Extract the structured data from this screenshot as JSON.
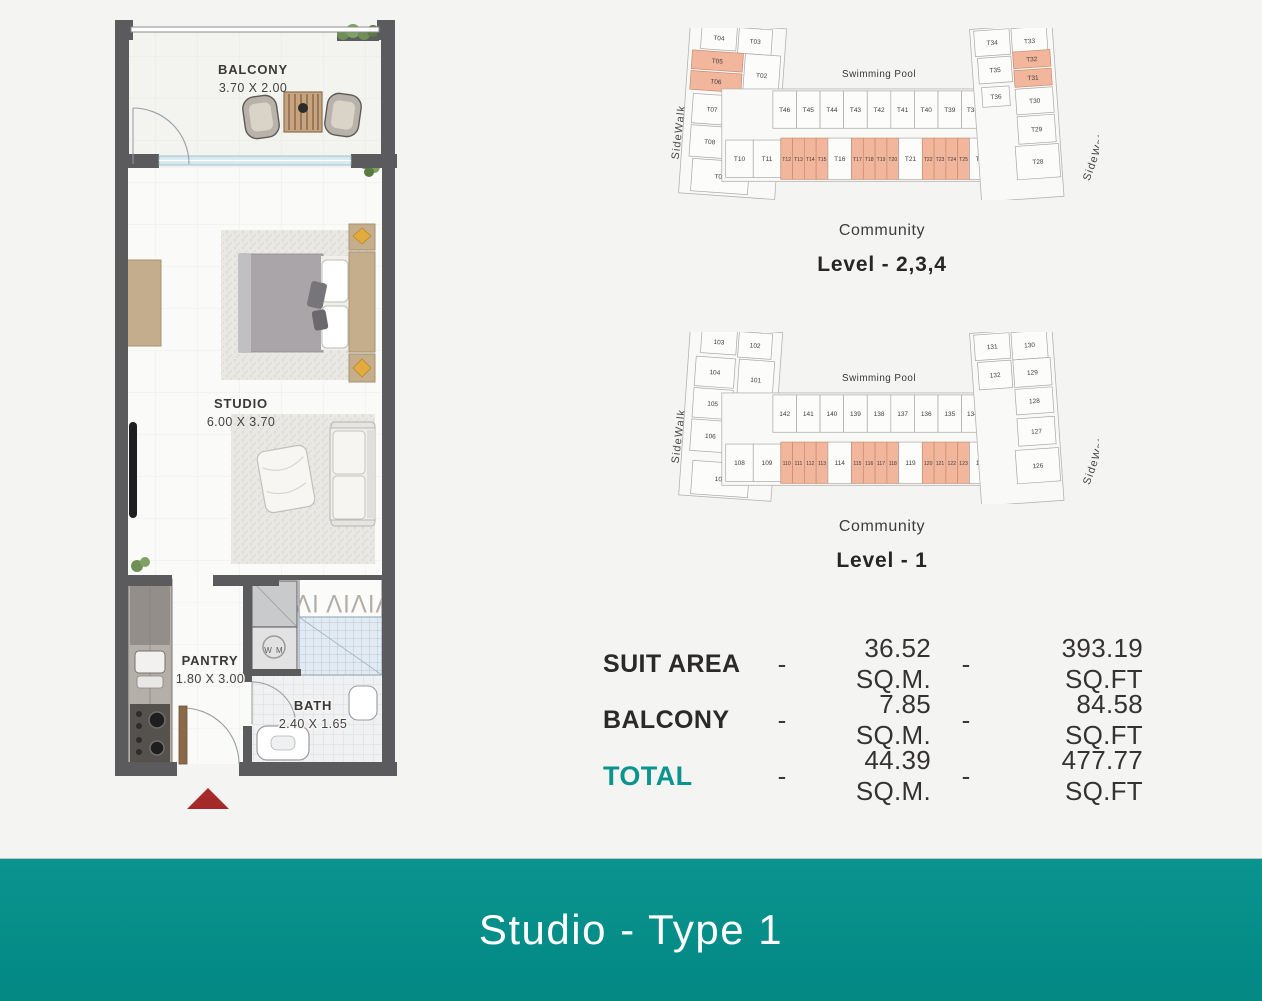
{
  "colors": {
    "accent": "#0a948f",
    "highlight": "#f1b69c",
    "wall": "#5b5b5e",
    "arrow": "#a32a28"
  },
  "floor_plan": {
    "balcony": {
      "name": "BALCONY",
      "dims": "3.70 X 2.00"
    },
    "studio": {
      "name": "STUDIO",
      "dims": "6.00 X 3.70"
    },
    "pantry": {
      "name": "PANTRY",
      "dims": "1.80 X 3.00"
    },
    "bath": {
      "name": "BATH",
      "dims": "2.40 X 1.65"
    },
    "wm_label": "W M",
    "wardrobe_glyphs": "ΙΛΙ ΛΙΛΙΛ"
  },
  "site_plans": [
    {
      "pool_label": "Swimming Pool",
      "sidewalk_left": "SideWalk",
      "sidewalk_right": "SideWalk",
      "community_label": "Community",
      "level_label": "Level - 2,3,4",
      "units": [
        {
          "t": "T04",
          "wing": "left",
          "x": 20,
          "y": 0,
          "w": 36,
          "h": 24,
          "hl": 0
        },
        {
          "t": "T03",
          "wing": "left",
          "x": 58,
          "y": 0,
          "w": 34,
          "h": 26,
          "hl": 0
        },
        {
          "t": "T05",
          "wing": "left",
          "x": 12,
          "y": 26,
          "w": 52,
          "h": 19,
          "hl": 1
        },
        {
          "t": "T02",
          "wing": "left",
          "x": 66,
          "y": 26,
          "w": 36,
          "h": 42,
          "hl": 0
        },
        {
          "t": "T06",
          "wing": "left",
          "x": 12,
          "y": 47,
          "w": 52,
          "h": 19,
          "hl": 1
        },
        {
          "t": "T07",
          "wing": "left",
          "x": 16,
          "y": 70,
          "w": 40,
          "h": 30,
          "hl": 0
        },
        {
          "t": "T01",
          "wing": "left",
          "x": 60,
          "y": 74,
          "w": 26,
          "h": 20,
          "hl": 0
        },
        {
          "t": "T08",
          "wing": "left",
          "x": 16,
          "y": 102,
          "w": 40,
          "h": 32,
          "hl": 0
        },
        {
          "t": "T09",
          "wing": "left",
          "x": 20,
          "y": 136,
          "w": 58,
          "h": 33,
          "hl": 0
        },
        {
          "t": "T46",
          "wing": "mid",
          "x": 104,
          "y": 64,
          "w": 24,
          "h": 38,
          "hl": 0
        },
        {
          "t": "T45",
          "wing": "mid",
          "x": 128,
          "y": 64,
          "w": 24,
          "h": 38,
          "hl": 0
        },
        {
          "t": "T44",
          "wing": "mid",
          "x": 152,
          "y": 64,
          "w": 24,
          "h": 38,
          "hl": 0
        },
        {
          "t": "T43",
          "wing": "mid",
          "x": 176,
          "y": 64,
          "w": 24,
          "h": 38,
          "hl": 0
        },
        {
          "t": "T42",
          "wing": "mid",
          "x": 200,
          "y": 64,
          "w": 24,
          "h": 38,
          "hl": 0
        },
        {
          "t": "T41",
          "wing": "mid",
          "x": 224,
          "y": 64,
          "w": 24,
          "h": 38,
          "hl": 0
        },
        {
          "t": "T40",
          "wing": "mid",
          "x": 248,
          "y": 64,
          "w": 24,
          "h": 38,
          "hl": 0
        },
        {
          "t": "T39",
          "wing": "mid",
          "x": 272,
          "y": 64,
          "w": 24,
          "h": 38,
          "hl": 0
        },
        {
          "t": "T38",
          "wing": "mid",
          "x": 296,
          "y": 64,
          "w": 22,
          "h": 38,
          "hl": 0
        },
        {
          "t": "T37",
          "wing": "mid",
          "x": 318,
          "y": 66,
          "w": 16,
          "h": 30,
          "hl": 0
        },
        {
          "t": "T10",
          "wing": "mid",
          "x": 56,
          "y": 114,
          "w": 28,
          "h": 38,
          "hl": 0
        },
        {
          "t": "T11",
          "wing": "mid",
          "x": 84,
          "y": 114,
          "w": 28,
          "h": 38,
          "hl": 0
        },
        {
          "t": "T12",
          "wing": "mid",
          "x": 112,
          "y": 112,
          "w": 12,
          "h": 42,
          "hl": 1
        },
        {
          "t": "T13",
          "wing": "mid",
          "x": 124,
          "y": 112,
          "w": 12,
          "h": 42,
          "hl": 1
        },
        {
          "t": "T14",
          "wing": "mid",
          "x": 136,
          "y": 112,
          "w": 12,
          "h": 42,
          "hl": 1
        },
        {
          "t": "T15",
          "wing": "mid",
          "x": 148,
          "y": 112,
          "w": 12,
          "h": 42,
          "hl": 1
        },
        {
          "t": "T16",
          "wing": "mid",
          "x": 160,
          "y": 112,
          "w": 24,
          "h": 42,
          "hl": 0
        },
        {
          "t": "T17",
          "wing": "mid",
          "x": 184,
          "y": 112,
          "w": 12,
          "h": 42,
          "hl": 1
        },
        {
          "t": "T18",
          "wing": "mid",
          "x": 196,
          "y": 112,
          "w": 12,
          "h": 42,
          "hl": 1
        },
        {
          "t": "T19",
          "wing": "mid",
          "x": 208,
          "y": 112,
          "w": 12,
          "h": 42,
          "hl": 1
        },
        {
          "t": "T20",
          "wing": "mid",
          "x": 220,
          "y": 112,
          "w": 12,
          "h": 42,
          "hl": 1
        },
        {
          "t": "T21",
          "wing": "mid",
          "x": 232,
          "y": 112,
          "w": 24,
          "h": 42,
          "hl": 0
        },
        {
          "t": "T22",
          "wing": "mid",
          "x": 256,
          "y": 112,
          "w": 12,
          "h": 42,
          "hl": 1
        },
        {
          "t": "T23",
          "wing": "mid",
          "x": 268,
          "y": 112,
          "w": 12,
          "h": 42,
          "hl": 1
        },
        {
          "t": "T24",
          "wing": "mid",
          "x": 280,
          "y": 112,
          "w": 12,
          "h": 42,
          "hl": 1
        },
        {
          "t": "T25",
          "wing": "mid",
          "x": 292,
          "y": 112,
          "w": 12,
          "h": 42,
          "hl": 1
        },
        {
          "t": "T26",
          "wing": "mid",
          "x": 304,
          "y": 112,
          "w": 24,
          "h": 42,
          "hl": 0
        },
        {
          "t": "T27",
          "wing": "mid",
          "x": 330,
          "y": 112,
          "w": 14,
          "h": 42,
          "hl": 1
        },
        {
          "t": "T34",
          "wing": "right",
          "x": 320,
          "y": 0,
          "w": 36,
          "h": 26,
          "hl": 0
        },
        {
          "t": "T33",
          "wing": "right",
          "x": 358,
          "y": 0,
          "w": 36,
          "h": 28,
          "hl": 0
        },
        {
          "t": "T35",
          "wing": "right",
          "x": 322,
          "y": 28,
          "w": 34,
          "h": 26,
          "hl": 0
        },
        {
          "t": "T32",
          "wing": "right",
          "x": 358,
          "y": 24,
          "w": 38,
          "h": 17,
          "hl": 1
        },
        {
          "t": "T31",
          "wing": "right",
          "x": 358,
          "y": 43,
          "w": 38,
          "h": 17,
          "hl": 1
        },
        {
          "t": "T36",
          "wing": "right",
          "x": 324,
          "y": 58,
          "w": 28,
          "h": 20,
          "hl": 0
        },
        {
          "t": "T30",
          "wing": "right",
          "x": 358,
          "y": 62,
          "w": 38,
          "h": 26,
          "hl": 0
        },
        {
          "t": "T29",
          "wing": "right",
          "x": 358,
          "y": 90,
          "w": 38,
          "h": 28,
          "hl": 0
        },
        {
          "t": "T28",
          "wing": "right",
          "x": 354,
          "y": 120,
          "w": 44,
          "h": 34,
          "hl": 0
        }
      ]
    },
    {
      "pool_label": "Swimming Pool",
      "sidewalk_left": "SideWalk",
      "sidewalk_right": "SideWalk",
      "community_label": "Community",
      "level_label": "Level - 1",
      "units": [
        {
          "t": "103",
          "wing": "left",
          "x": 20,
          "y": 0,
          "w": 36,
          "h": 24,
          "hl": 0
        },
        {
          "t": "102",
          "wing": "left",
          "x": 58,
          "y": 0,
          "w": 34,
          "h": 26,
          "hl": 0
        },
        {
          "t": "104",
          "wing": "left",
          "x": 16,
          "y": 28,
          "w": 40,
          "h": 30,
          "hl": 0
        },
        {
          "t": "101",
          "wing": "left",
          "x": 60,
          "y": 28,
          "w": 36,
          "h": 40,
          "hl": 0
        },
        {
          "t": "105",
          "wing": "left",
          "x": 16,
          "y": 60,
          "w": 40,
          "h": 30,
          "hl": 0
        },
        {
          "t": "106",
          "wing": "left",
          "x": 16,
          "y": 92,
          "w": 40,
          "h": 32,
          "hl": 0
        },
        {
          "t": "107",
          "wing": "left",
          "x": 20,
          "y": 134,
          "w": 58,
          "h": 34,
          "hl": 0
        },
        {
          "t": "142",
          "wing": "mid",
          "x": 104,
          "y": 64,
          "w": 24,
          "h": 38,
          "hl": 0
        },
        {
          "t": "141",
          "wing": "mid",
          "x": 128,
          "y": 64,
          "w": 24,
          "h": 38,
          "hl": 0
        },
        {
          "t": "140",
          "wing": "mid",
          "x": 152,
          "y": 64,
          "w": 24,
          "h": 38,
          "hl": 0
        },
        {
          "t": "139",
          "wing": "mid",
          "x": 176,
          "y": 64,
          "w": 24,
          "h": 38,
          "hl": 0
        },
        {
          "t": "138",
          "wing": "mid",
          "x": 200,
          "y": 64,
          "w": 24,
          "h": 38,
          "hl": 0
        },
        {
          "t": "137",
          "wing": "mid",
          "x": 224,
          "y": 64,
          "w": 24,
          "h": 38,
          "hl": 0
        },
        {
          "t": "136",
          "wing": "mid",
          "x": 248,
          "y": 64,
          "w": 24,
          "h": 38,
          "hl": 0
        },
        {
          "t": "135",
          "wing": "mid",
          "x": 272,
          "y": 64,
          "w": 24,
          "h": 38,
          "hl": 0
        },
        {
          "t": "134",
          "wing": "mid",
          "x": 296,
          "y": 64,
          "w": 22,
          "h": 38,
          "hl": 0
        },
        {
          "t": "133",
          "wing": "mid",
          "x": 318,
          "y": 66,
          "w": 16,
          "h": 30,
          "hl": 0
        },
        {
          "t": "108",
          "wing": "mid",
          "x": 56,
          "y": 114,
          "w": 28,
          "h": 38,
          "hl": 0
        },
        {
          "t": "109",
          "wing": "mid",
          "x": 84,
          "y": 114,
          "w": 28,
          "h": 38,
          "hl": 0
        },
        {
          "t": "110",
          "wing": "mid",
          "x": 112,
          "y": 112,
          "w": 12,
          "h": 42,
          "hl": 1
        },
        {
          "t": "111",
          "wing": "mid",
          "x": 124,
          "y": 112,
          "w": 12,
          "h": 42,
          "hl": 1
        },
        {
          "t": "112",
          "wing": "mid",
          "x": 136,
          "y": 112,
          "w": 12,
          "h": 42,
          "hl": 1
        },
        {
          "t": "113",
          "wing": "mid",
          "x": 148,
          "y": 112,
          "w": 12,
          "h": 42,
          "hl": 1
        },
        {
          "t": "114",
          "wing": "mid",
          "x": 160,
          "y": 112,
          "w": 24,
          "h": 42,
          "hl": 0
        },
        {
          "t": "115",
          "wing": "mid",
          "x": 184,
          "y": 112,
          "w": 12,
          "h": 42,
          "hl": 1
        },
        {
          "t": "116",
          "wing": "mid",
          "x": 196,
          "y": 112,
          "w": 12,
          "h": 42,
          "hl": 1
        },
        {
          "t": "117",
          "wing": "mid",
          "x": 208,
          "y": 112,
          "w": 12,
          "h": 42,
          "hl": 1
        },
        {
          "t": "118",
          "wing": "mid",
          "x": 220,
          "y": 112,
          "w": 12,
          "h": 42,
          "hl": 1
        },
        {
          "t": "119",
          "wing": "mid",
          "x": 232,
          "y": 112,
          "w": 24,
          "h": 42,
          "hl": 0
        },
        {
          "t": "120",
          "wing": "mid",
          "x": 256,
          "y": 112,
          "w": 12,
          "h": 42,
          "hl": 1
        },
        {
          "t": "121",
          "wing": "mid",
          "x": 268,
          "y": 112,
          "w": 12,
          "h": 42,
          "hl": 1
        },
        {
          "t": "122",
          "wing": "mid",
          "x": 280,
          "y": 112,
          "w": 12,
          "h": 42,
          "hl": 1
        },
        {
          "t": "123",
          "wing": "mid",
          "x": 292,
          "y": 112,
          "w": 12,
          "h": 42,
          "hl": 1
        },
        {
          "t": "124",
          "wing": "mid",
          "x": 304,
          "y": 112,
          "w": 24,
          "h": 42,
          "hl": 0
        },
        {
          "t": "125",
          "wing": "mid",
          "x": 330,
          "y": 112,
          "w": 14,
          "h": 42,
          "hl": 1
        },
        {
          "t": "131",
          "wing": "right",
          "x": 320,
          "y": 0,
          "w": 36,
          "h": 26,
          "hl": 0
        },
        {
          "t": "130",
          "wing": "right",
          "x": 358,
          "y": 0,
          "w": 36,
          "h": 28,
          "hl": 0
        },
        {
          "t": "132",
          "wing": "right",
          "x": 322,
          "y": 28,
          "w": 34,
          "h": 28,
          "hl": 0
        },
        {
          "t": "129",
          "wing": "right",
          "x": 358,
          "y": 28,
          "w": 38,
          "h": 28,
          "hl": 0
        },
        {
          "t": "128",
          "wing": "right",
          "x": 358,
          "y": 58,
          "w": 38,
          "h": 26,
          "hl": 0
        },
        {
          "t": "127",
          "wing": "right",
          "x": 358,
          "y": 88,
          "w": 38,
          "h": 28,
          "hl": 0
        },
        {
          "t": "126",
          "wing": "right",
          "x": 354,
          "y": 120,
          "w": 44,
          "h": 34,
          "hl": 0
        }
      ]
    }
  ],
  "areas": {
    "rows": [
      {
        "label": "SUIT AREA",
        "sep1": "-",
        "sqm": "36.52 SQ.M.",
        "sep2": "-",
        "sqft": "393.19 SQ.FT",
        "accent": false
      },
      {
        "label": "BALCONY",
        "sep1": "-",
        "sqm": "7.85 SQ.M.",
        "sep2": "-",
        "sqft": "84.58 SQ.FT",
        "accent": false
      },
      {
        "label": "TOTAL",
        "sep1": "-",
        "sqm": "44.39 SQ.M.",
        "sep2": "-",
        "sqft": "477.77 SQ.FT",
        "accent": true
      }
    ]
  },
  "banner": {
    "title": "Studio - Type 1"
  }
}
